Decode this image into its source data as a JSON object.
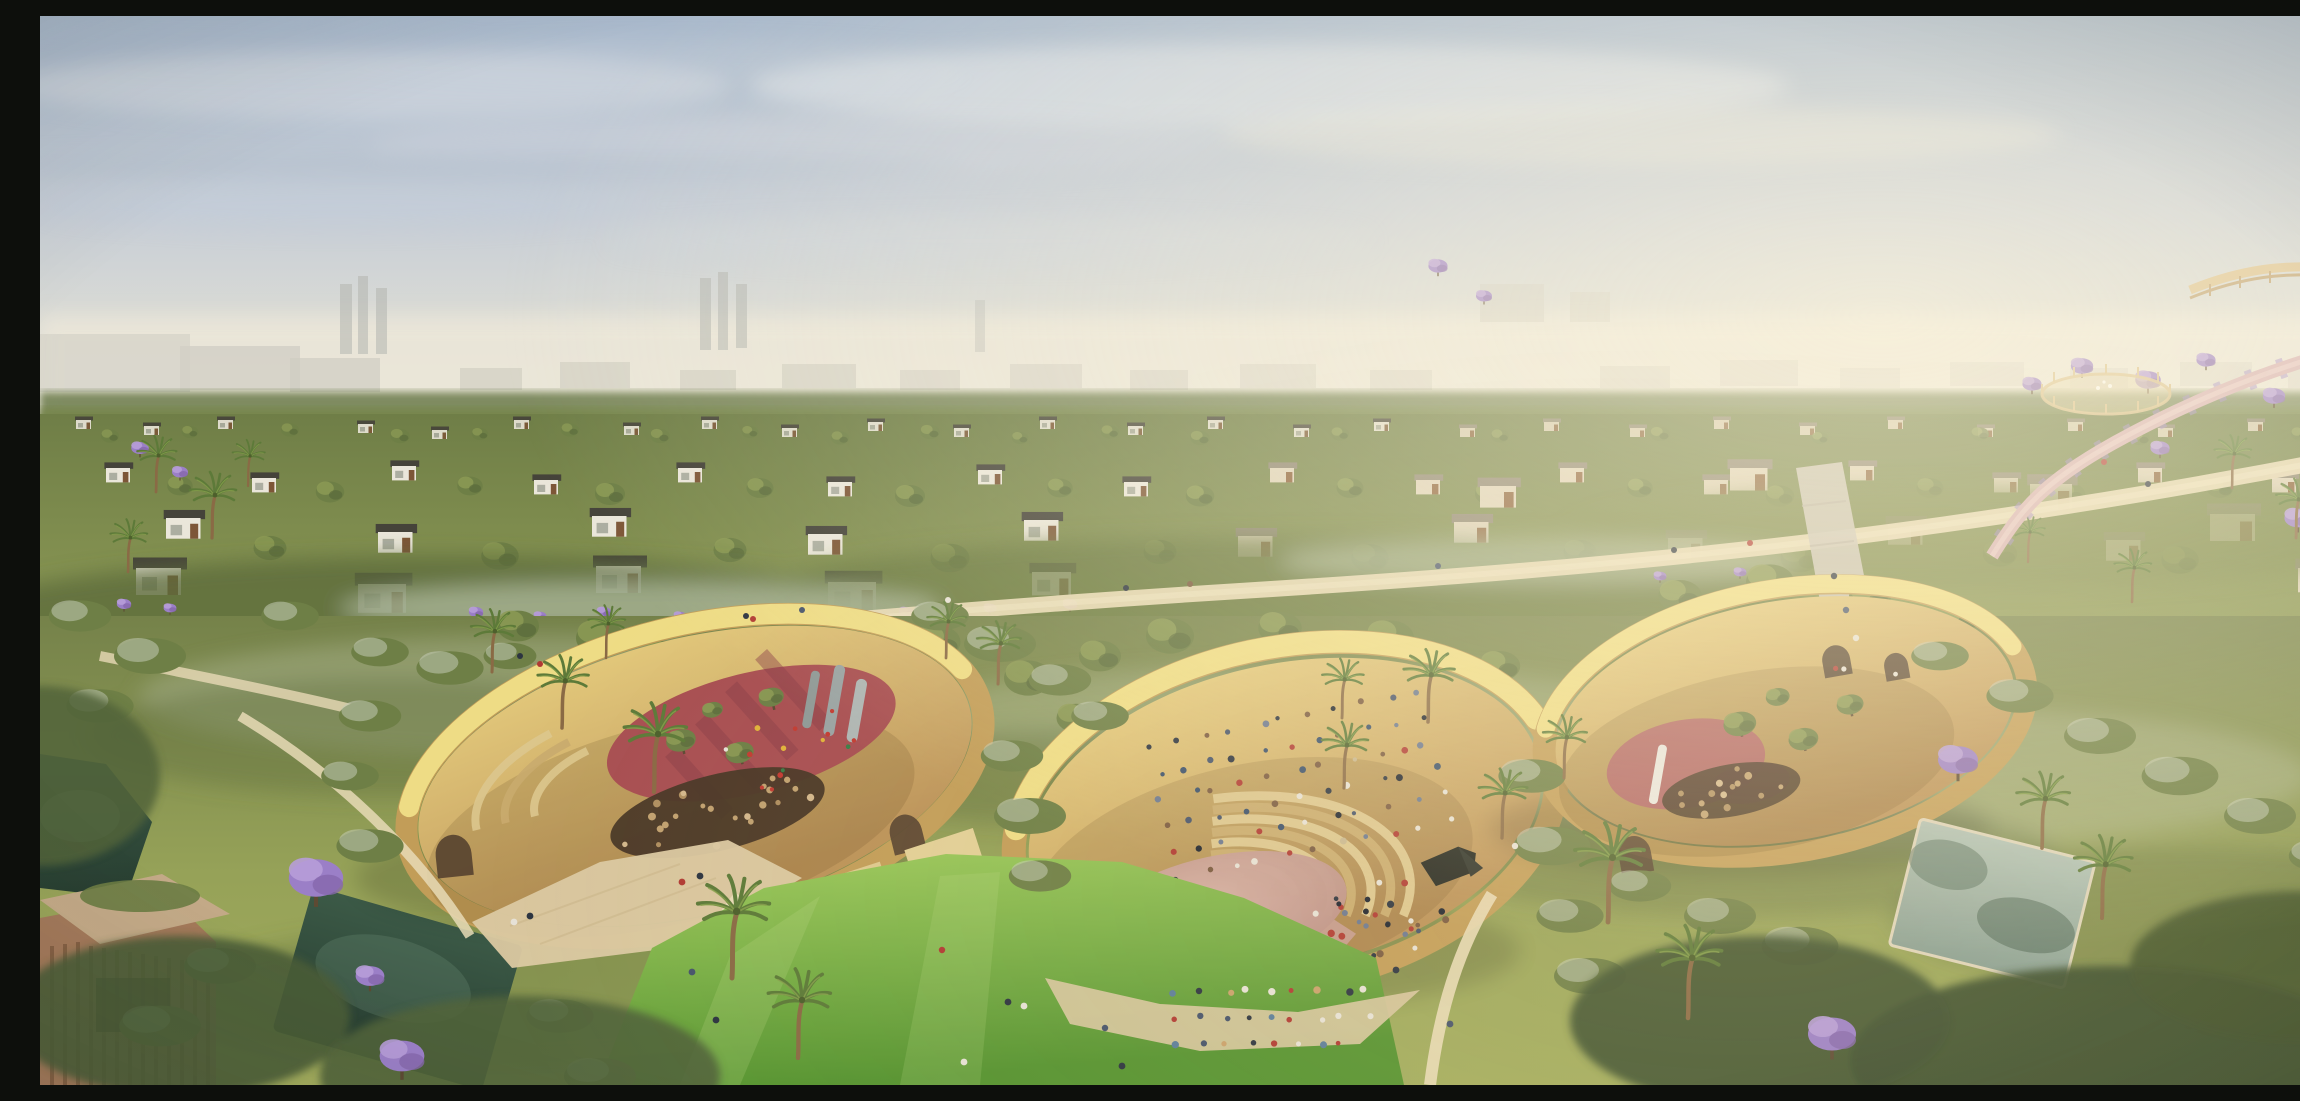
{
  "scene": {
    "type": "architectural-aerial-render",
    "setting": "Aerial rendering of a villa community around a landscaped park with three curved sandstone amphitheatre shells, palm and jacaranda trees, ponds and an outdoor concert",
    "time_of_day": "hazy golden afternoon",
    "counts": {
      "amphitheatre_shells": 3,
      "ponds": 3,
      "palm_trees": 26,
      "jacaranda_trees": 17,
      "villa_rows": 4
    }
  },
  "palette": {
    "sky_top": "#a9b9cc",
    "sky_mid": "#c6cdd6",
    "sky_low": "#ddddd5",
    "haze": "#ece7d9",
    "distant_block": "#c8c6ba",
    "tree_dark": "#556539",
    "tree_mid": "#6e7f46",
    "tree_light": "#8c9a55",
    "sage": "#c2cbb4",
    "lawn_dark": "#559330",
    "lawn_light": "#9fcb5d",
    "ground_olive": "#7d8a4c",
    "sand_sun": "#eedc85",
    "sand_shade": "#c29d58",
    "dirt_light": "#e6cd7e",
    "dirt_dark": "#bb9258",
    "stage_floor": "#c79c92",
    "play_red": "#a84f52",
    "play_maroon": "#8b3f49",
    "slide_grey": "#9aa3a3",
    "path": "#dccba3",
    "path_light": "#e8dab6",
    "pond_dark": "#2f4a3a",
    "pond_light": "#9fb4a8",
    "jacaranda": "#9b7fc7",
    "jacaranda_light": "#b79dd8",
    "villa_wall": "#eae6da",
    "villa_wall_warm": "#ddd2ba",
    "villa_roof": "#45433a",
    "villa_wood": "#7d5637",
    "palm_frond": "#5d7a39",
    "palm_trunk": "#8a6a45",
    "building_wall": "#a3795a",
    "building_slat": "#6e4c33"
  },
  "crowds": [
    {
      "target": "crowd-amph-seated",
      "count": 66,
      "mode": "rows",
      "rows": 6,
      "dot": 2.8,
      "seed": 11,
      "colors": [
        "#2c3440",
        "#46536b",
        "#6b7890",
        "#b03a33",
        "#e6e1d6",
        "#7a5a40",
        "#394f6b",
        "#c8b78f",
        "#1f2530"
      ]
    },
    {
      "target": "crowd-stage-choir",
      "count": 46,
      "mode": "scatter",
      "dot": 3.0,
      "seed": 23,
      "colors": [
        "#2c3440",
        "#46536b",
        "#b03a33",
        "#e6e1d6",
        "#d8b23c",
        "#7a5a40",
        "#1f2530",
        "#5b7d9a"
      ]
    },
    {
      "target": "crowd-stage-audience",
      "count": 40,
      "mode": "scatter",
      "dot": 3.0,
      "seed": 37,
      "colors": [
        "#2c3440",
        "#46536b",
        "#6b7890",
        "#e6e1d6",
        "#7a5a40",
        "#1f2530",
        "#b03a33"
      ]
    },
    {
      "target": "crowd-lawn",
      "count": 26,
      "mode": "rows",
      "rows": 3,
      "dot": 3.0,
      "seed": 51,
      "colors": [
        "#e6e1d6",
        "#2c3440",
        "#b03a33",
        "#5b7d9a",
        "#c9a16b",
        "#46536b"
      ]
    },
    {
      "target": "crowd-playground",
      "count": 14,
      "mode": "scatter",
      "dot": 2.6,
      "seed": 67,
      "colors": [
        "#c23b32",
        "#2d5f9e",
        "#e0b33a",
        "#e6e1d6",
        "#3a7d46",
        "#2c3440"
      ]
    },
    {
      "target": "stumps-left",
      "count": 24,
      "mode": "scatter",
      "dot": 3.2,
      "seed": 73,
      "colors": [
        "#d3b78c",
        "#c1a170",
        "#b08f60"
      ]
    },
    {
      "target": "stumps-right",
      "count": 14,
      "mode": "scatter",
      "dot": 3.2,
      "seed": 89,
      "colors": [
        "#d3b78c",
        "#c1a170",
        "#b08f60"
      ]
    }
  ]
}
